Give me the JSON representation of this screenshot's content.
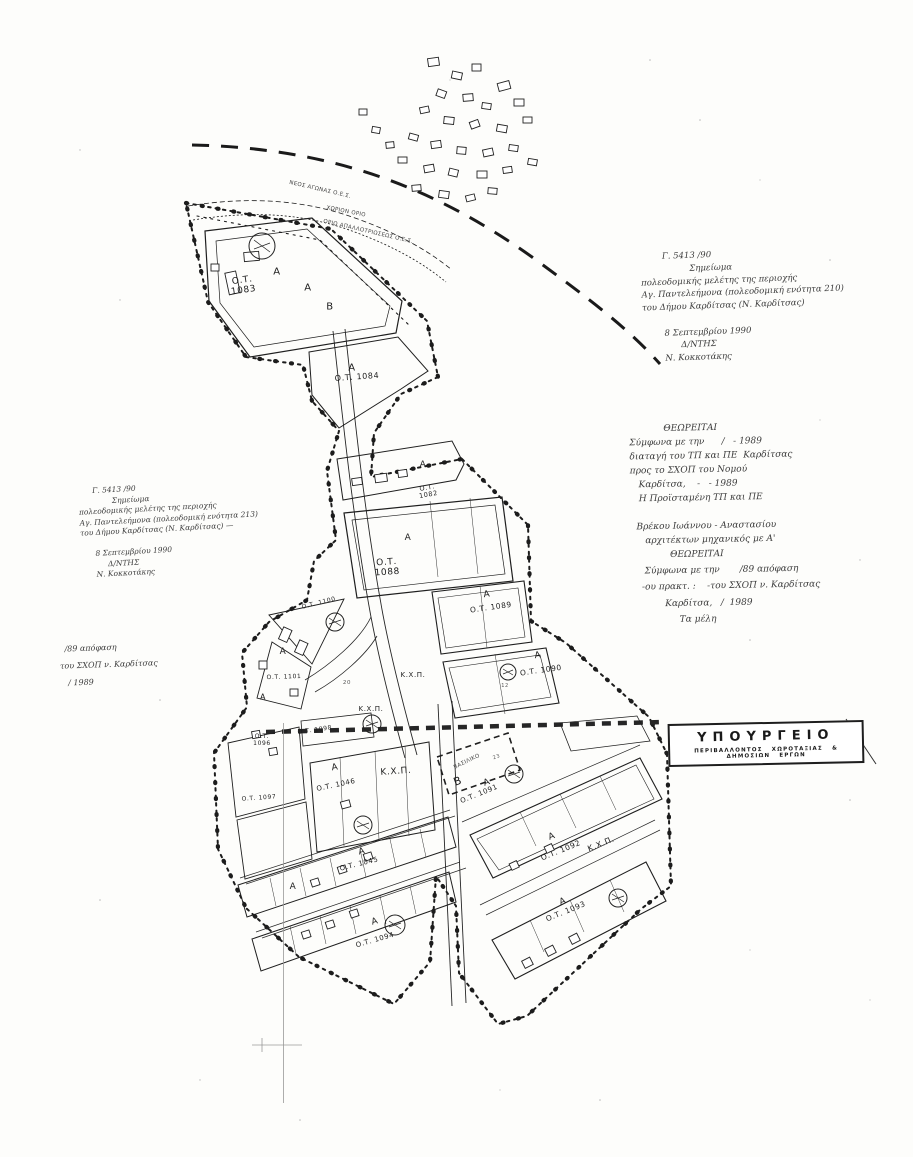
{
  "colors": {
    "ink": "#1d1d1d",
    "faded_ink": "#3c3c3c",
    "paper": "#fdfdfb"
  },
  "stamp": {
    "title": "ΥΠΟΥΡΓΕΙΟ",
    "subtitle": "ΠΕΡΙΒΑΛΛΟΝΤΟΣ  ΧΩΡΟΤΑΞΙΑΣ  &  ΔΗΜΟΣΙΩΝ  ΕΡΓΩΝ"
  },
  "annotations": {
    "approval_right": {
      "lines": [
        "        Γ. 5413 /90",
        "                  Σημείωμα",
        "πολεοδομικής μελέτης της περιοχής",
        "Αγ. Παντελεήμονα (πολεοδομική ενότητα 210)",
        "του Δήμου Καρδίτσας (Ν. Καρδίτσας)",
        "",
        "        8 Σεπτεμβρίου 1990",
        "              Δ/ΝΤΗΣ",
        "        Ν. Κοκκοτάκης"
      ]
    },
    "approval_left": {
      "lines": [
        "      Γ. 5413 /90",
        "              Σημείωμα",
        "πολεοδομικής μελέτης της περιοχής",
        "Αγ. Παντελεήμονα (πολεοδομική ενότητα 213)",
        "του Δήμου Καρδίτσας (Ν. Καρδίτσας) —",
        "",
        "      8 Σεπτεμβρίου 1990",
        "           Δ/ΝΤΗΣ",
        "      Ν. Κοκκοτάκης"
      ]
    },
    "theoreitai_a": {
      "lines": [
        "            ΘΕΩΡΕΙΤΑΙ",
        "Σύμφωνα με την      /   - 1989",
        "διαταγή του ΤΠ και ΠΕ  Καρδίτσας",
        "προς το ΣΧΟΠ του Νομού",
        "   Καρδίτσα,    -   - 1989",
        "   Η Προϊσταμένη ΤΠ και ΠΕ",
        "",
        "  Βρέκου Ιωάννου - Αναστασίου",
        "     αρχιτέκτων μηχανικός με Α'"
      ]
    },
    "theoreitai_b": {
      "lines": [
        "          ΘΕΩΡΕΙΤΑΙ",
        " Σύμφωνα με την       /89 απόφαση",
        "-ου πρακτ. :    -του ΣΧΟΠ ν. Καρδίτσας",
        "        Καρδίτσα,   /  1989",
        "             Τα μέλη"
      ]
    },
    "decision_left": {
      "lines": [
        "  /89 απόφαση",
        "του ΣΧΟΠ ν. Καρδίτσας",
        "   / 1989"
      ]
    }
  },
  "map": {
    "labels": [
      {
        "name": "block-label-1083",
        "cls": "blk",
        "text": "Ο.Τ.\n1083",
        "x": 243,
        "y": 286,
        "rot": -8,
        "size": 9
      },
      {
        "name": "block-label-1084",
        "cls": "blk",
        "text": "Ο.Τ. 1084",
        "x": 357,
        "y": 377,
        "rot": -4,
        "size": 8
      },
      {
        "name": "block-label-1082",
        "cls": "blk",
        "text": "Ο.Τ.\n1082",
        "x": 428,
        "y": 492,
        "rot": -10,
        "size": 6.5
      },
      {
        "name": "block-label-1088",
        "cls": "blk",
        "text": "Ο.Τ.\n1088",
        "x": 387,
        "y": 568,
        "rot": -4,
        "size": 9
      },
      {
        "name": "block-label-1089",
        "cls": "blk",
        "text": "Ο.Τ. 1089",
        "x": 491,
        "y": 608,
        "rot": -8,
        "size": 7.5
      },
      {
        "name": "block-label-1090",
        "cls": "blk",
        "text": "Ο.Τ. 1090",
        "x": 541,
        "y": 671,
        "rot": -8,
        "size": 7.5
      },
      {
        "name": "block-label-1100",
        "cls": "blk",
        "text": "Ο.Τ. 1100",
        "x": 319,
        "y": 604,
        "rot": -14,
        "size": 6
      },
      {
        "name": "block-label-1101",
        "cls": "blk",
        "text": "Ο.Τ. 1101",
        "x": 284,
        "y": 678,
        "rot": -2,
        "size": 6
      },
      {
        "name": "block-label-1098",
        "cls": "blk",
        "text": "Ο.Τ. 1098",
        "x": 315,
        "y": 731,
        "rot": -8,
        "size": 6
      },
      {
        "name": "block-label-1096",
        "cls": "blk",
        "text": "Ο.Τ.\n1096",
        "x": 262,
        "y": 741,
        "rot": 0,
        "size": 6
      },
      {
        "name": "block-label-1097",
        "cls": "blk",
        "text": "Ο.Τ. 1097",
        "x": 259,
        "y": 799,
        "rot": -4,
        "size": 6
      },
      {
        "name": "block-label-1046",
        "cls": "blk",
        "text": "Ο.Τ. 1046",
        "x": 336,
        "y": 785,
        "rot": -12,
        "size": 7
      },
      {
        "name": "block-label-1045",
        "cls": "blk",
        "text": "Ο.Τ. 1045",
        "x": 359,
        "y": 864,
        "rot": -14,
        "size": 7
      },
      {
        "name": "block-label-1094",
        "cls": "blk",
        "text": "Ο.Τ. 1094",
        "x": 375,
        "y": 940,
        "rot": -16,
        "size": 7
      },
      {
        "name": "block-label-1091",
        "cls": "blk",
        "text": "Ο.Τ. 1091",
        "x": 479,
        "y": 794,
        "rot": -22,
        "size": 7
      },
      {
        "name": "block-label-1092",
        "cls": "blk",
        "text": "Ο.Τ. 1092",
        "x": 561,
        "y": 851,
        "rot": -22,
        "size": 7.5
      },
      {
        "name": "block-label-1093",
        "cls": "blk",
        "text": "Ο.Τ. 1093",
        "x": 566,
        "y": 912,
        "rot": -22,
        "size": 7.5
      },
      {
        "name": "zone-label-a",
        "cls": "zone",
        "text": "Α",
        "x": 277,
        "y": 272,
        "rot": 0,
        "size": 10
      },
      {
        "name": "zone-label-a",
        "cls": "zone",
        "text": "Α",
        "x": 308,
        "y": 288,
        "rot": 0,
        "size": 10
      },
      {
        "name": "zone-label-a",
        "cls": "zone",
        "text": "Α",
        "x": 352,
        "y": 368,
        "rot": 0,
        "size": 10
      },
      {
        "name": "zone-label-a",
        "cls": "zone",
        "text": "Α",
        "x": 423,
        "y": 465,
        "rot": 0,
        "size": 9
      },
      {
        "name": "zone-label-a",
        "cls": "zone",
        "text": "Α",
        "x": 408,
        "y": 538,
        "rot": 0,
        "size": 9
      },
      {
        "name": "zone-label-a",
        "cls": "zone",
        "text": "Α",
        "x": 487,
        "y": 595,
        "rot": -8,
        "size": 9
      },
      {
        "name": "zone-label-a",
        "cls": "zone",
        "text": "Α",
        "x": 538,
        "y": 656,
        "rot": -8,
        "size": 9
      },
      {
        "name": "zone-label-a",
        "cls": "zone",
        "text": "Α",
        "x": 283,
        "y": 652,
        "rot": 0,
        "size": 9
      },
      {
        "name": "zone-label-a",
        "cls": "zone",
        "text": "Α",
        "x": 263,
        "y": 697,
        "rot": 0,
        "size": 8
      },
      {
        "name": "zone-label-a",
        "cls": "zone",
        "text": "Α",
        "x": 335,
        "y": 768,
        "rot": -10,
        "size": 9
      },
      {
        "name": "zone-label-a",
        "cls": "zone",
        "text": "Α",
        "x": 362,
        "y": 852,
        "rot": -14,
        "size": 9
      },
      {
        "name": "zone-label-a",
        "cls": "zone",
        "text": "Α",
        "x": 293,
        "y": 887,
        "rot": 0,
        "size": 9
      },
      {
        "name": "zone-label-a",
        "cls": "zone",
        "text": "Α",
        "x": 375,
        "y": 922,
        "rot": -16,
        "size": 9
      },
      {
        "name": "zone-label-a",
        "cls": "zone",
        "text": "Α",
        "x": 487,
        "y": 783,
        "rot": -20,
        "size": 9
      },
      {
        "name": "zone-label-a",
        "cls": "zone",
        "text": "Α",
        "x": 552,
        "y": 837,
        "rot": -20,
        "size": 9
      },
      {
        "name": "zone-label-a",
        "cls": "zone",
        "text": "Α",
        "x": 563,
        "y": 902,
        "rot": -20,
        "size": 9
      },
      {
        "name": "zone-label-b",
        "cls": "zone",
        "text": "Β",
        "x": 330,
        "y": 307,
        "rot": 0,
        "size": 10
      },
      {
        "name": "zone-label-b",
        "cls": "zone",
        "text": "Β",
        "x": 458,
        "y": 782,
        "rot": -20,
        "size": 11
      },
      {
        "name": "public-space-label",
        "cls": "kxp",
        "text": "Κ.Χ.Π.",
        "x": 413,
        "y": 675,
        "rot": 0,
        "size": 7
      },
      {
        "name": "public-space-label",
        "cls": "kxp",
        "text": "Κ.Χ.Π.",
        "x": 371,
        "y": 709,
        "rot": 0,
        "size": 7
      },
      {
        "name": "public-space-label",
        "cls": "kxp",
        "text": "Κ.Χ.Π.",
        "x": 396,
        "y": 772,
        "rot": -4,
        "size": 9
      },
      {
        "name": "public-space-label",
        "cls": "kxp",
        "text": "Κ.Χ.Π.",
        "x": 601,
        "y": 844,
        "rot": -22,
        "size": 8
      },
      {
        "name": "lot-number",
        "cls": "lot",
        "text": "20",
        "x": 347,
        "y": 683,
        "rot": 0,
        "size": 5.5
      },
      {
        "name": "lot-number",
        "cls": "lot",
        "text": "12",
        "x": 505,
        "y": 687,
        "rot": 0,
        "size": 5
      },
      {
        "name": "lot-number",
        "cls": "lot",
        "text": "23",
        "x": 497,
        "y": 758,
        "rot": -20,
        "size": 5
      },
      {
        "name": "boundary-label",
        "cls": "bnd",
        "text": "ΝΕΟΣ ΑΓΩΝΑΣ Ο.Ε.Σ.",
        "x": 320,
        "y": 190,
        "rot": 13,
        "size": 5.5
      },
      {
        "name": "boundary-label",
        "cls": "bnd",
        "text": "ΧΩΡΙΟΝ ΟΡΙΟ",
        "x": 346,
        "y": 212,
        "rot": 11,
        "size": 5.5
      },
      {
        "name": "boundary-label",
        "cls": "bnd",
        "text": "ΟΡΙΟ ΑΠΑΛΛΟΤΡΙΩΣΕΩΣ Ο.Ε.Σ.",
        "x": 368,
        "y": 232,
        "rot": 13,
        "size": 5.5
      },
      {
        "name": "site-label",
        "cls": "bnd",
        "text": "ΒΑΣΙΛΙΚΟ",
        "x": 467,
        "y": 762,
        "rot": -26,
        "size": 5.5
      }
    ]
  }
}
